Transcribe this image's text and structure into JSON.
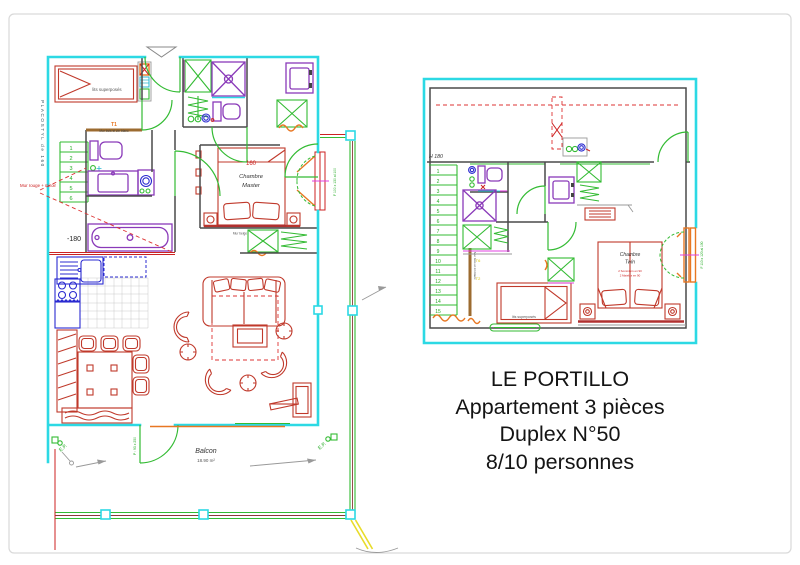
{
  "page": {
    "background": "#ffffff",
    "border_color": "#d9d9d9"
  },
  "caption": {
    "line1": "LE PORTILLO",
    "line2": "Appartement 3 pièces",
    "line3": "Duplex N°50",
    "line4": "8/10 personnes"
  },
  "colors": {
    "wall_cyan": "#2cd9e4",
    "furniture_red": "#c0392b",
    "fixture_purple": "#8a3ab9",
    "kitchen_blue": "#2b2bd0",
    "door_green": "#33bb33",
    "accent_orange": "#e87722",
    "wood_tan": "#9c6b30",
    "dark_wall": "#4a4a4a",
    "magenta": "#e040e0",
    "yellow": "#e8dc2a"
  },
  "plan_lower": {
    "title": "niveau bas",
    "labels": {
      "placostyl": "PLACOSTYL de 160",
      "t1": "T1",
      "mur_bois": "Mur bois et zin blanc",
      "mur_rouge": "Mur rouge + miroir",
      "lits_superposes": "lits superposés",
      "bath_level": "-180",
      "bed_width": "160",
      "chambre": "Chambre",
      "master": "Master",
      "mur_beige": "Mur beige",
      "balcon": "Balcon",
      "balcon_area": "18.90 m²",
      "ep_left": "E.P.",
      "ep_right": "E.P.",
      "porte_balcon": "P : 93 x 250",
      "fenetre": "F 100 x 130 al 100"
    },
    "stairs": [
      "1",
      "2",
      "3",
      "4",
      "5",
      "6"
    ]
  },
  "plan_upper": {
    "title": "niveau haut",
    "labels": {
      "h180": "H 180",
      "mur_bois": "Mur bois et zin blanc",
      "t6": "T6",
      "t2": "T2",
      "chambre": "Chambre",
      "twin": "Twin",
      "note1": "2 Sommiers en 90",
      "note2": "2 Matelas en 90",
      "lits_superposes": "lits superposés",
      "fenetre": "F 110 x 120 al 100"
    },
    "stairs": [
      "1",
      "2",
      "3",
      "4",
      "5",
      "6",
      "7",
      "8",
      "9",
      "10",
      "11",
      "12",
      "13",
      "14",
      "15"
    ]
  }
}
